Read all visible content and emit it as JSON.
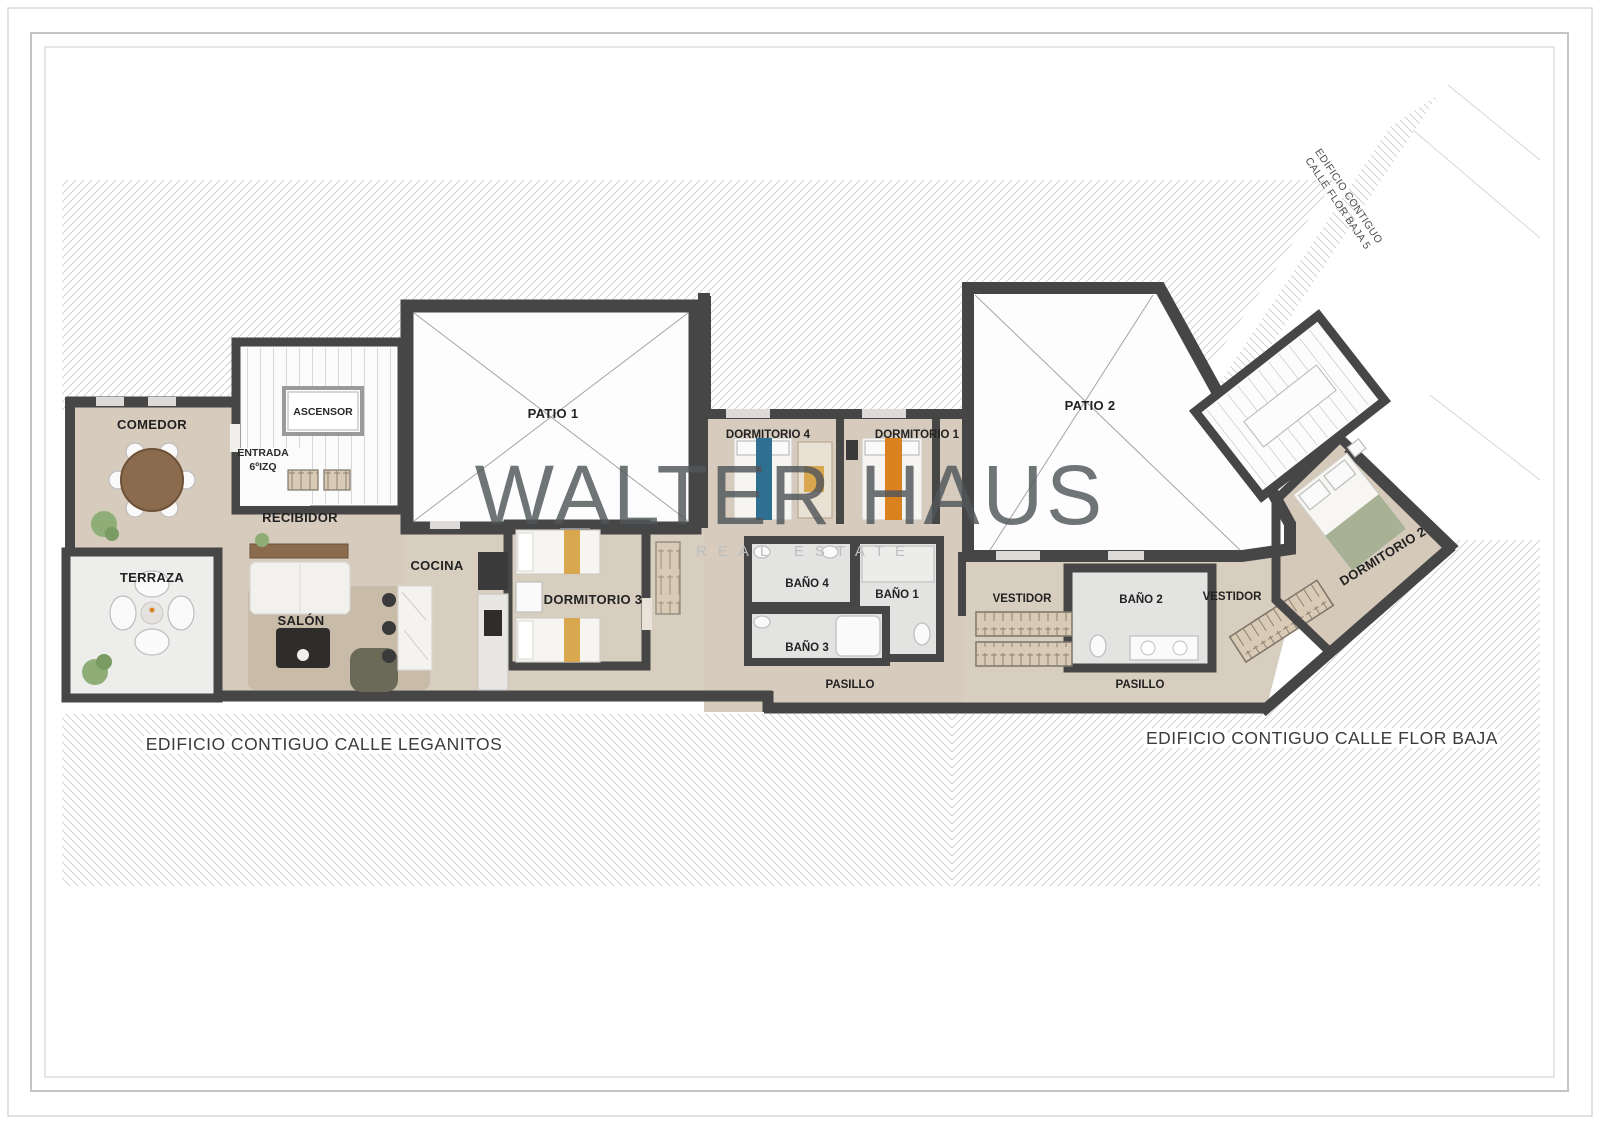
{
  "watermark": {
    "name": "WALTER HAUS",
    "tagline": "REAL ESTATE"
  },
  "rooms": {
    "comedor": "COMEDOR",
    "terraza": "TERRAZA",
    "recibidor": "RECIBIDOR",
    "salon": "SALÓN",
    "cocina": "COCINA",
    "ascensor": "ASCENSOR",
    "entrada_line1": "ENTRADA",
    "entrada_line2": "6ºIZQ",
    "patio1": "PATIO 1",
    "patio2": "PATIO 2",
    "dormitorio1": "DORMITORIO 1",
    "dormitorio2": "DORMITORIO 2",
    "dormitorio3": "DORMITORIO 3",
    "dormitorio4": "DORMITORIO 4",
    "bano1": "BAÑO 1",
    "bano2": "BAÑO 2",
    "bano3": "BAÑO 3",
    "bano4": "BAÑO 4",
    "vestidor_left": "VESTIDOR",
    "vestidor_right": "VESTIDOR",
    "pasillo_left": "PASILLO",
    "pasillo_right": "PASILLO"
  },
  "surroundings": {
    "calle_leganitos": "EDIFICIO CONTIGUO CALLE LEGANITOS",
    "calle_flor_baja": "EDIFICIO CONTIGUO CALLE FLOR BAJA",
    "flor_baja5_line1": "EDIFICIO CONTIGUO",
    "flor_baja5_line2": "CALLE FLOR BAJA 5"
  },
  "colors": {
    "wall": "#464646",
    "floor": "#d6cbbc",
    "terrace_floor": "#ededeb",
    "patio_fill": "#fdfdfd",
    "bath_floor": "#e3e3e2",
    "hatch_line": "#d2d2d2",
    "closet": "#d8cab4",
    "wood": "#8b6b4e",
    "accent_blue": "#2f6f92",
    "accent_orange": "#d9821f",
    "accent_mustard": "#d9a84e",
    "accent_green": "#a9b194",
    "label": "#222222",
    "watermark": "#51565a"
  }
}
